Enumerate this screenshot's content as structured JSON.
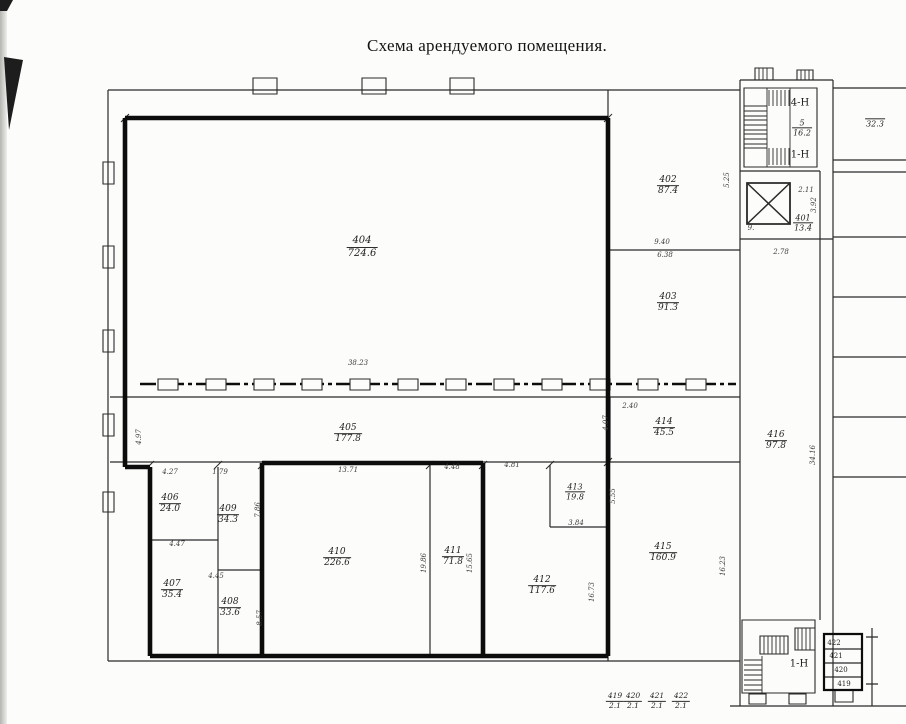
{
  "page": {
    "title": "Схема арендуемого помещения."
  },
  "colors": {
    "ink": "#2a2a2a",
    "bold": "#0c0c0c",
    "paper": "#fcfcfa"
  },
  "plan": {
    "rooms": [
      {
        "num": "404",
        "area": "724.6",
        "x": 362,
        "y": 247,
        "s": 10
      },
      {
        "num": "402",
        "area": "87.4",
        "x": 668,
        "y": 186
      },
      {
        "num": "403",
        "area": "91.3",
        "x": 668,
        "y": 303
      },
      {
        "num": "405",
        "area": "177.8",
        "x": 348,
        "y": 434
      },
      {
        "num": "414",
        "area": "45.5",
        "x": 664,
        "y": 428
      },
      {
        "num": "406",
        "area": "24.0",
        "x": 170,
        "y": 504
      },
      {
        "num": "409",
        "area": "34.3",
        "x": 228,
        "y": 515
      },
      {
        "num": "407",
        "area": "35.4",
        "x": 172,
        "y": 590
      },
      {
        "num": "408",
        "area": "33.6",
        "x": 230,
        "y": 608
      },
      {
        "num": "410",
        "area": "226.6",
        "x": 337,
        "y": 558
      },
      {
        "num": "411",
        "area": "71.8",
        "x": 453,
        "y": 557
      },
      {
        "num": "412",
        "area": "117.6",
        "x": 542,
        "y": 586
      },
      {
        "num": "413",
        "area": "19.8",
        "x": 575,
        "y": 492,
        "s": 8
      },
      {
        "num": "415",
        "area": "160.9",
        "x": 663,
        "y": 553
      },
      {
        "num": "416",
        "area": "97.8",
        "x": 776,
        "y": 441
      },
      {
        "num": "401",
        "area": "13.4",
        "x": 803,
        "y": 223,
        "s": 8
      },
      {
        "num": "5",
        "area": "16.2",
        "x": 802,
        "y": 128,
        "s": 8
      },
      {
        "num": "",
        "area": "32.3",
        "x": 875,
        "y": 119,
        "s": 8
      }
    ],
    "dims": [
      {
        "t": "38.23",
        "x": 358,
        "y": 363
      },
      {
        "t": "9.40",
        "x": 662,
        "y": 242
      },
      {
        "t": "6.38",
        "x": 665,
        "y": 255
      },
      {
        "t": "5.25",
        "x": 727,
        "y": 180,
        "rot": true
      },
      {
        "t": "2.40",
        "x": 630,
        "y": 406
      },
      {
        "t": "4.07",
        "x": 606,
        "y": 423,
        "rot": true
      },
      {
        "t": "2.11",
        "x": 806,
        "y": 190
      },
      {
        "t": "3.92",
        "x": 814,
        "y": 205,
        "rot": true
      },
      {
        "t": "9.",
        "x": 751,
        "y": 228
      },
      {
        "t": "2.78",
        "x": 781,
        "y": 252
      },
      {
        "t": "4.27",
        "x": 170,
        "y": 472
      },
      {
        "t": "1.79",
        "x": 220,
        "y": 472
      },
      {
        "t": "7.86",
        "x": 258,
        "y": 510,
        "rot": true
      },
      {
        "t": "4.47",
        "x": 177,
        "y": 544
      },
      {
        "t": "4.45",
        "x": 216,
        "y": 576
      },
      {
        "t": "8.57",
        "x": 260,
        "y": 618,
        "rot": true
      },
      {
        "t": "13.71",
        "x": 348,
        "y": 470
      },
      {
        "t": "4.48",
        "x": 452,
        "y": 467
      },
      {
        "t": "4.81",
        "x": 512,
        "y": 465
      },
      {
        "t": "19.86",
        "x": 424,
        "y": 563,
        "rot": true
      },
      {
        "t": "15.65",
        "x": 470,
        "y": 563,
        "rot": true
      },
      {
        "t": "16.73",
        "x": 592,
        "y": 592,
        "rot": true
      },
      {
        "t": "3.84",
        "x": 576,
        "y": 523
      },
      {
        "t": "5.55",
        "x": 613,
        "y": 496,
        "rot": true
      },
      {
        "t": "34.16",
        "x": 813,
        "y": 455,
        "rot": true
      },
      {
        "t": "16.23",
        "x": 723,
        "y": 566,
        "rot": true
      },
      {
        "t": "4.97",
        "x": 139,
        "y": 437,
        "rot": true
      }
    ],
    "texts": [
      {
        "t": "4-Н",
        "x": 800,
        "y": 103,
        "s": 10
      },
      {
        "t": "1-Н",
        "x": 800,
        "y": 155,
        "s": 10
      },
      {
        "t": "1-Н",
        "x": 799,
        "y": 664,
        "s": 10
      },
      {
        "t": "422",
        "x": 834,
        "y": 643,
        "s": 7
      },
      {
        "t": "421",
        "x": 836,
        "y": 656,
        "s": 7
      },
      {
        "t": "420",
        "x": 841,
        "y": 670,
        "s": 7
      },
      {
        "t": "419",
        "x": 844,
        "y": 684,
        "s": 7
      }
    ],
    "bottom_row_y": 701,
    "bottom_row": [
      {
        "num": "419",
        "area": "2.1",
        "x": 615
      },
      {
        "num": "420",
        "area": "2.1",
        "x": 633
      },
      {
        "num": "421",
        "area": "2.1",
        "x": 657
      },
      {
        "num": "422",
        "area": "2.1",
        "x": 681
      }
    ]
  }
}
